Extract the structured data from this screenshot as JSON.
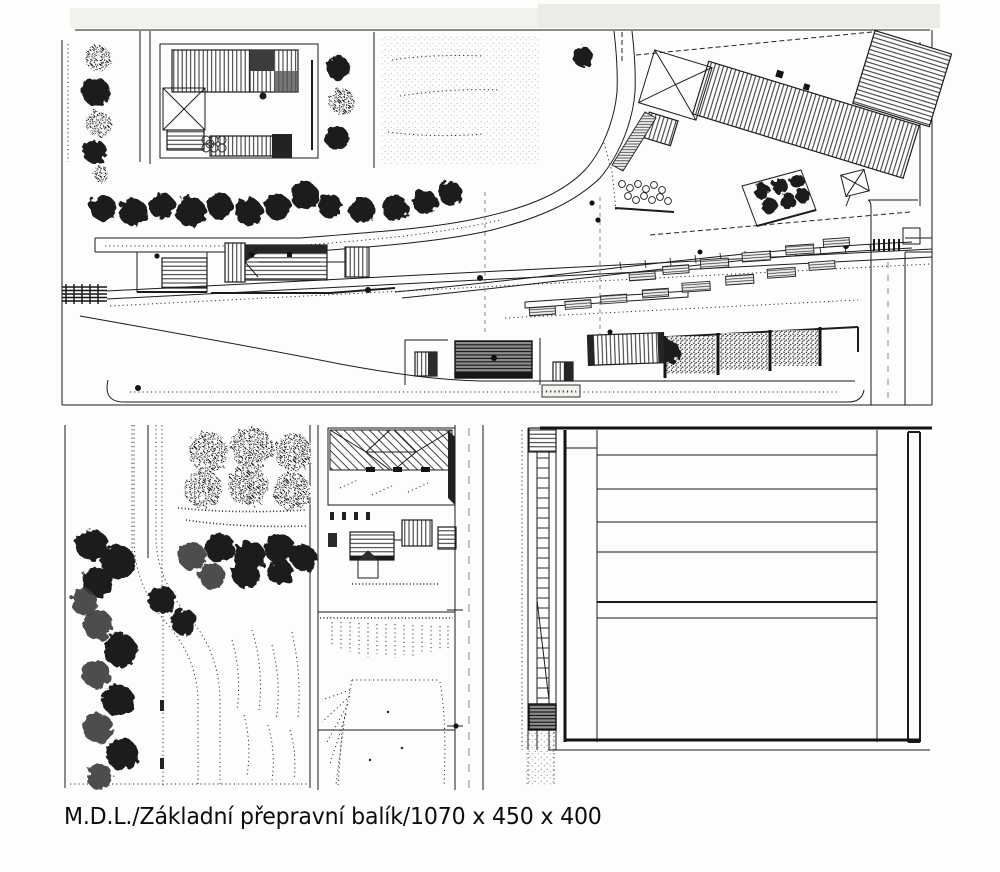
{
  "caption": {
    "text": "M.D.L./Základní přepravní balík/1070 x 450 x 400"
  },
  "drawing": {
    "ink_color": "#1c1c1c",
    "paper_color": "#fdfdfc",
    "modules": {
      "top_module": "station-scene-plan",
      "bottom_left_module": "orchard-and-country-road-plan",
      "bottom_middle_module": "villa-and-embankment-plan",
      "bottom_right_module": "loading-yard-plan"
    }
  }
}
